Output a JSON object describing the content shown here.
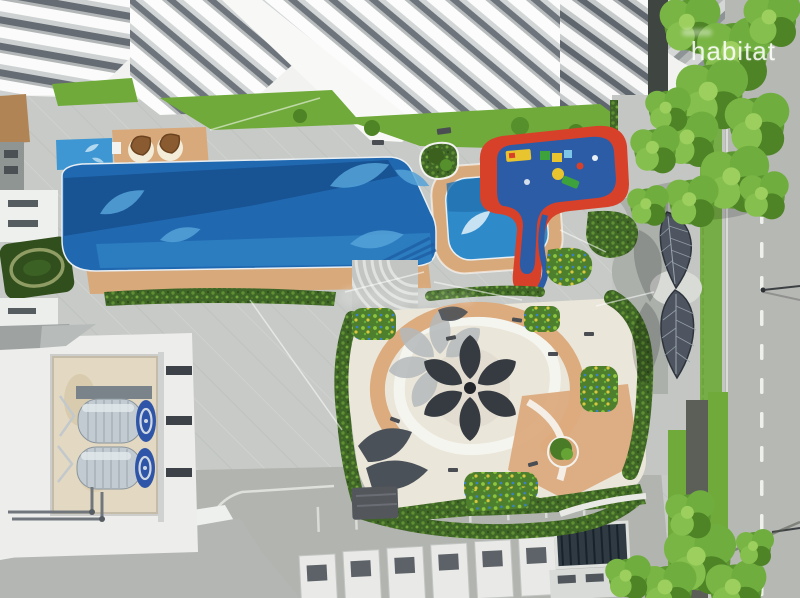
{
  "watermark": {
    "brand": "habitat"
  },
  "palette": {
    "deck": "#c7cac6",
    "deckLight": "#d8dad6",
    "sidewalk": "#c3c6c2",
    "road": "#b6b8b4",
    "buildingWhite": "#f2f3f1",
    "windowDark": "#6d747b",
    "poolDeep": "#2069b1",
    "poolShadow": "#17508f",
    "poolLight": "#2e7ec2",
    "leafMotif": "#55a3d9",
    "kidsPool": "#2f8aca",
    "toddlerPool": "#3e97d2",
    "sand": "#d8a97b",
    "terracotta": "#dcab7e",
    "cream": "#ebe6da",
    "pathWhite": "#f6f5f1",
    "hedge": "#3f6527",
    "grass": "#6faa3a",
    "treeGreen": "#79b544",
    "treeDark": "#4e8326",
    "playRed": "#d84129",
    "playBlue": "#2d5ca6",
    "playYellow": "#e8c52e",
    "canopyDark": "#4e5560",
    "petalDark": "#363b42",
    "petalShadow": "#b5babc",
    "tankSilver": "#c2cbd2",
    "tankBlue": "#2e55a8",
    "watermarkWhite": "#ffffff"
  }
}
